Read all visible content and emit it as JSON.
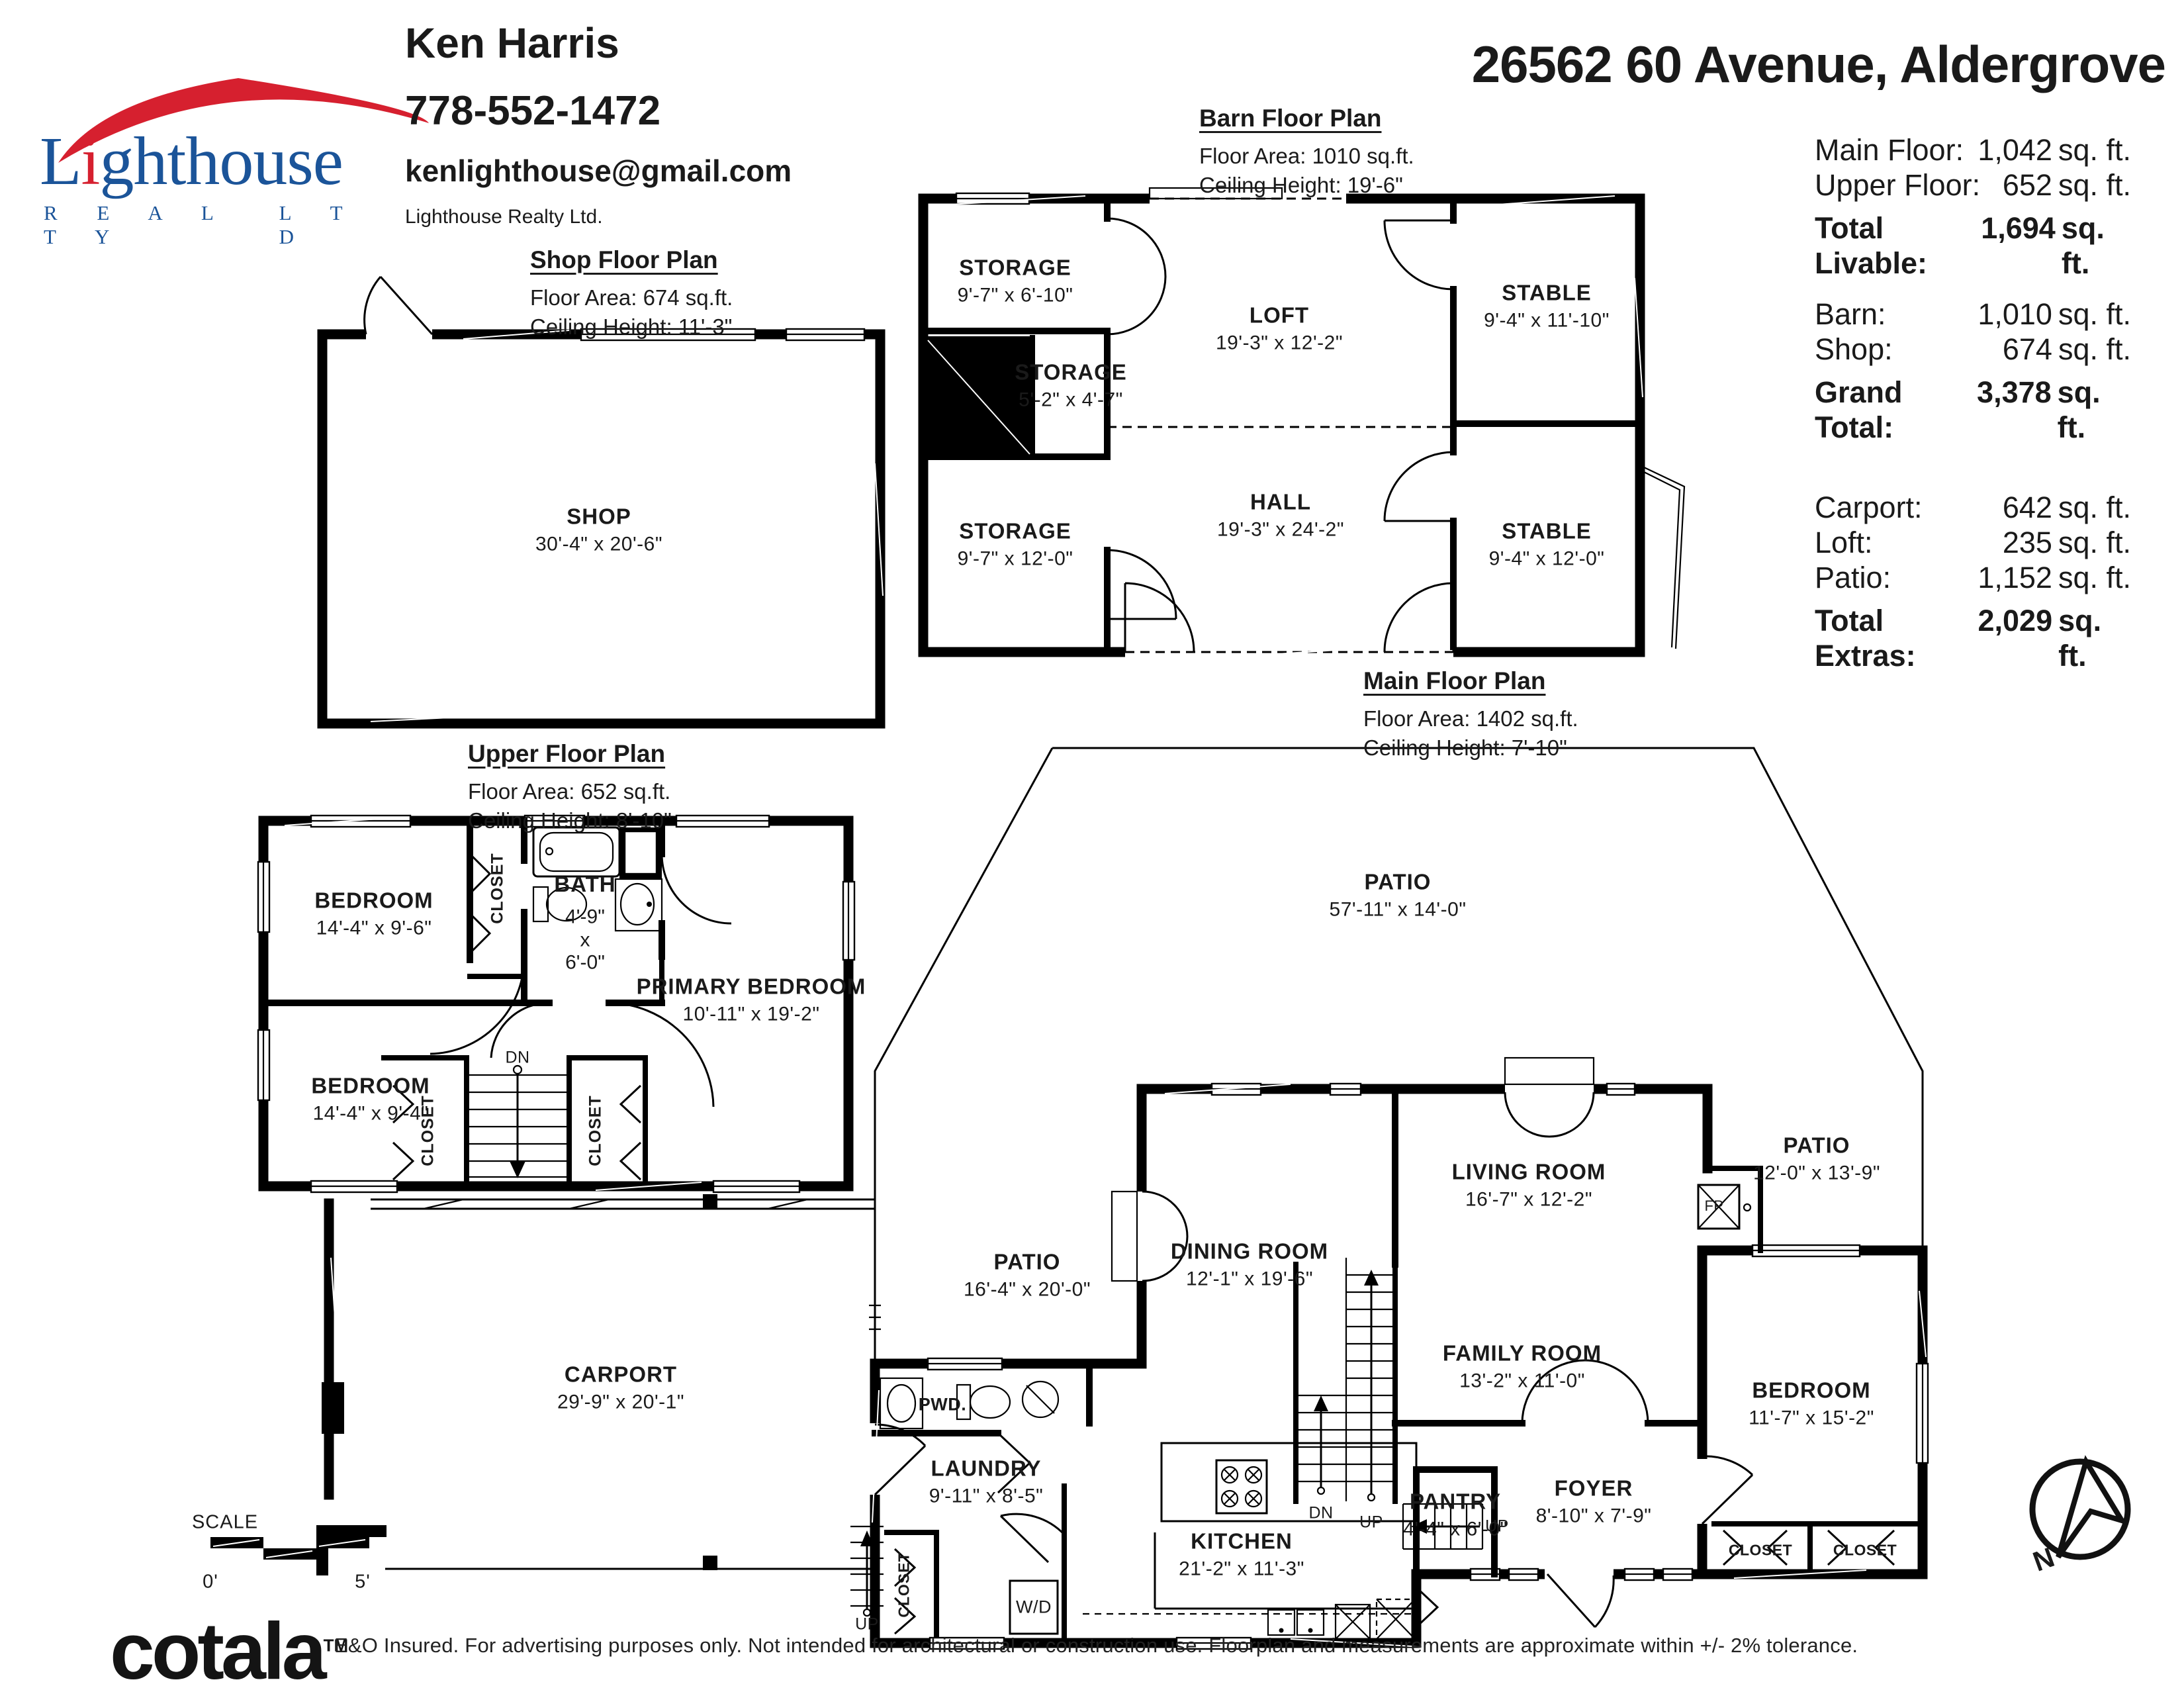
{
  "branding": {
    "word_l": "L",
    "word_i": "i",
    "word_rest": "ghthouse",
    "realty": "R E A L T Y",
    "ltd": "L T D",
    "colors": {
      "blue": "#1b5499",
      "red": "#d6202f"
    }
  },
  "agent": {
    "name": "Ken Harris",
    "phone": "778-552-1472",
    "email": "kenlighthouse@gmail.com",
    "company": "Lighthouse Realty Ltd."
  },
  "address": "26562 60 Avenue, Aldergrove",
  "summary": {
    "rows": [
      {
        "label": "Main Floor:",
        "value": "1,042",
        "unit": "sq. ft."
      },
      {
        "label": "Upper Floor:",
        "value": "652",
        "unit": "sq. ft."
      },
      {
        "label": "Total Livable:",
        "value": "1,694",
        "unit": "sq. ft."
      },
      {
        "label": "Barn:",
        "value": "1,010",
        "unit": "sq. ft."
      },
      {
        "label": "Shop:",
        "value": "674",
        "unit": "sq. ft."
      },
      {
        "label": "Grand Total:",
        "value": "3,378",
        "unit": "sq. ft."
      },
      {
        "label": "Carport:",
        "value": "642",
        "unit": "sq. ft."
      },
      {
        "label": "Loft:",
        "value": "235",
        "unit": "sq. ft."
      },
      {
        "label": "Patio:",
        "value": "1,152",
        "unit": "sq. ft."
      },
      {
        "label": "Total Extras:",
        "value": "2,029",
        "unit": "sq. ft."
      }
    ]
  },
  "plans": {
    "shop": {
      "title": "Shop Floor Plan",
      "area": "Floor Area: 674 sq.ft.",
      "ceiling": "Ceiling Height: 11'-3\"",
      "rooms": [
        {
          "name": "SHOP",
          "dims": "30'-4\" x 20'-6\""
        }
      ]
    },
    "barn": {
      "title": "Barn Floor Plan",
      "area": "Floor Area: 1010 sq.ft.",
      "ceiling": "Ceiling Height: 19'-6\"",
      "rooms": [
        {
          "name": "STORAGE",
          "dims": "9'-7\" x 6'-10\""
        },
        {
          "name": "LOFT",
          "dims": "19'-3\" x 12'-2\""
        },
        {
          "name": "STABLE",
          "dims": "9'-4\" x 11'-10\""
        },
        {
          "name": "STORAGE",
          "dims": "5'-2\" x 4'-7\""
        },
        {
          "name": "STORAGE",
          "dims": "9'-7\" x 12'-0\""
        },
        {
          "name": "HALL",
          "dims": "19'-3\" x 24'-2\""
        },
        {
          "name": "STABLE",
          "dims": "9'-4\" x 12'-0\""
        }
      ]
    },
    "upper": {
      "title": "Upper Floor Plan",
      "area": "Floor Area: 652 sq.ft.",
      "ceiling": "Ceiling Height: 8'-10\"",
      "rooms": [
        {
          "name": "BEDROOM",
          "dims": "14'-4\" x 9'-6\""
        },
        {
          "name": "BATH",
          "dims_lines": "4'-9\"\nx\n6'-0\""
        },
        {
          "name": "PRIMARY BEDROOM",
          "dims": "10'-11\" x 19'-2\""
        },
        {
          "name": "BEDROOM",
          "dims": "14'-4\" x 9'-4\""
        }
      ],
      "small": {
        "closet_top": "CLOSET",
        "closet_bl": "CLOSET",
        "closet_br": "CLOSET",
        "dn": "DN"
      }
    },
    "main": {
      "title": "Main Floor Plan",
      "area": "Floor Area: 1402 sq.ft.",
      "ceiling": "Ceiling Height: 7'-10\"",
      "rooms": [
        {
          "name": "PATIO",
          "dims": "57'-11\" x 14'-0\""
        },
        {
          "name": "PATIO",
          "dims": "16'-4\" x 20'-0\""
        },
        {
          "name": "DINING ROOM",
          "dims": "12'-1\" x 19'-6\""
        },
        {
          "name": "LIVING ROOM",
          "dims": "16'-7\" x 12'-2\""
        },
        {
          "name": "PATIO",
          "dims": "12'-0\" x 13'-9\""
        },
        {
          "name": "FAMILY ROOM",
          "dims": "13'-2\" x 11'-0\""
        },
        {
          "name": "BEDROOM",
          "dims": "11'-7\" x 15'-2\""
        },
        {
          "name": "LAUNDRY",
          "dims": "9'-11\" x 8'-5\""
        },
        {
          "name": "KITCHEN",
          "dims": "21'-2\" x 11'-3\""
        },
        {
          "name": "PANTRY",
          "dims": "4'-4\" x 6'-0\""
        },
        {
          "name": "FOYER",
          "dims": "8'-10\" x 7'-9\""
        },
        {
          "name": "CARPORT",
          "dims": "29'-9\" x 20'-1\""
        }
      ],
      "small": {
        "pwd": "PWD.",
        "wd": "W/D",
        "fp": "FP",
        "closet_hall": "CLOSET",
        "closet_b1": "CLOSET",
        "closet_b2": "CLOSET",
        "dn": "DN",
        "up_center": "UP",
        "up_side": "UP",
        "up_ext": "UP"
      }
    }
  },
  "scale_bar": {
    "label": "SCALE",
    "start": "0'",
    "end": "5'"
  },
  "compass": {
    "label": "N"
  },
  "footer": {
    "logo": "cotala",
    "tm": "TM",
    "disclaimer": "E&O Insured. For advertising purposes only. Not intended for architectural or construction use. Floorplan and measurements are approximate within +/- 2% tolerance."
  }
}
